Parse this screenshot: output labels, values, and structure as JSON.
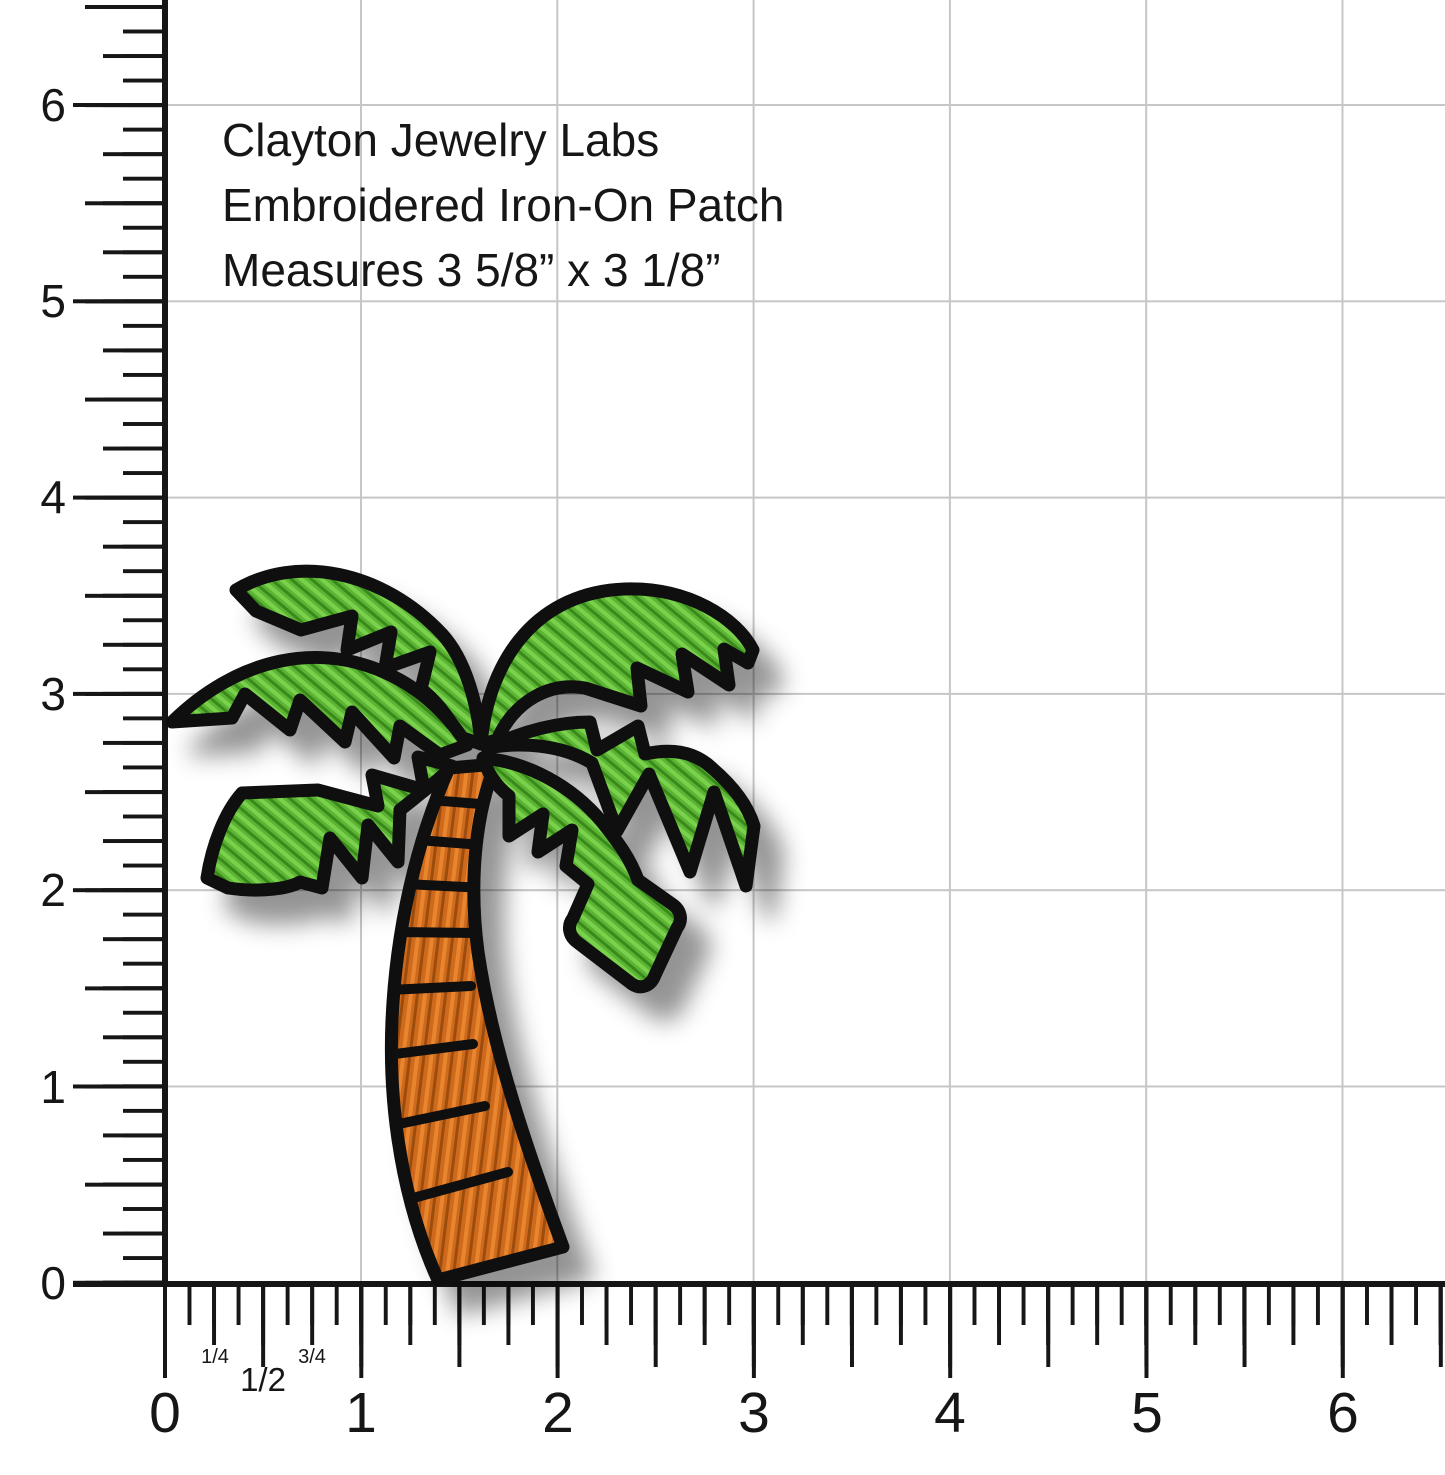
{
  "theme": {
    "ink": "#161616",
    "tick": "#161616",
    "grid": "#c6c6c6",
    "outline": "#0f0f0f",
    "green": "#5cb434",
    "green_hi": "#79d14c",
    "green_lo": "#3a8a1b",
    "orange": "#cf6a1d",
    "orange_hi": "#e8862f",
    "orange_lo": "#9c4d0e",
    "shadow": "rgba(0,0,0,0.42)"
  },
  "product_label": {
    "line1": "Clayton Jewelry Labs",
    "line2": "Embroidered Iron-On Patch",
    "line3": "Measures 3 5/8” x 3 1/8”"
  },
  "ruler": {
    "left_labels": [
      "6",
      "5",
      "4",
      "3",
      "2",
      "1",
      "0"
    ],
    "bottom_labels": [
      "0",
      "1",
      "2",
      "3",
      "4",
      "5",
      "6"
    ],
    "bottom_fractions": [
      "1/4",
      "1/2",
      "3/4"
    ]
  },
  "patch": {
    "icon": "palm-tree-patch"
  }
}
